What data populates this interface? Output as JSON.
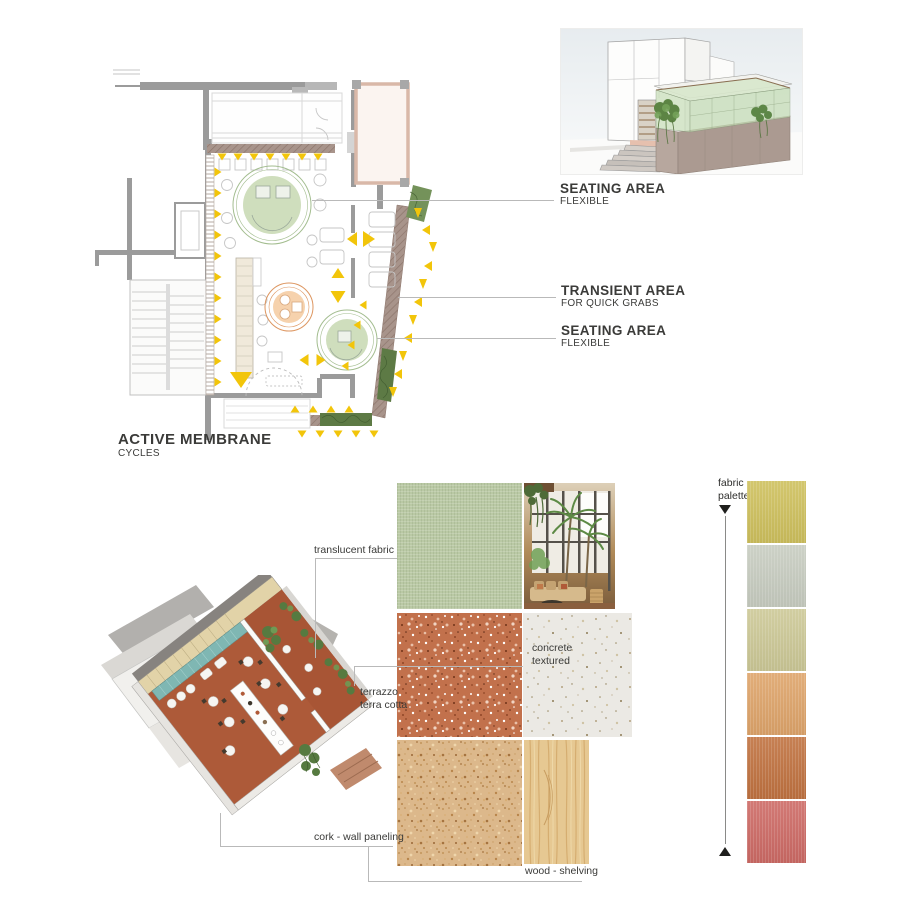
{
  "plan_annotations": {
    "seating_1": {
      "title": "SEATING AREA",
      "subtitle": "FLEXIBLE"
    },
    "transient": {
      "title": "TRANSIENT AREA",
      "subtitle": "FOR QUICK GRABS"
    },
    "seating_2": {
      "title": "SEATING AREA",
      "subtitle": "FLEXIBLE"
    },
    "membrane": {
      "title": "ACTIVE MEMBRANE",
      "subtitle": "CYCLES"
    }
  },
  "materials": {
    "translucent_fabric": {
      "label": "translucent fabric",
      "color": "#bac9a5"
    },
    "terrazzo": {
      "label_line1": "terrazzo",
      "label_line2": "terra cotta",
      "color": "#c2714c"
    },
    "concrete": {
      "label_line1": "concrete",
      "label_line2": "textured",
      "color": "#ebe9e4"
    },
    "cork": {
      "label": "cork - wall paneling",
      "color": "#dcb88b"
    },
    "wood": {
      "label": "wood - shelving",
      "color": "#e6c892"
    }
  },
  "fabric_palette": {
    "label_line1": "fabric",
    "label_line2": "palette",
    "swatches": [
      {
        "color": "#cec05d"
      },
      {
        "color": "#c7ccc0"
      },
      {
        "color": "#ccc896"
      },
      {
        "color": "#dea46a"
      },
      {
        "color": "#c07240"
      },
      {
        "color": "#cd6a65"
      }
    ]
  },
  "colors": {
    "marker_yellow": "#f2c50a",
    "membrane_brown": "#a8948b",
    "seating_green": "#c8d9b4",
    "seating_green_stroke": "#a3bd8f",
    "transient_orange": "#f5cda4",
    "transient_orange_stroke": "#dd9660",
    "wall_gray": "#9b9b9b",
    "planter_green": "#5d7a45"
  }
}
